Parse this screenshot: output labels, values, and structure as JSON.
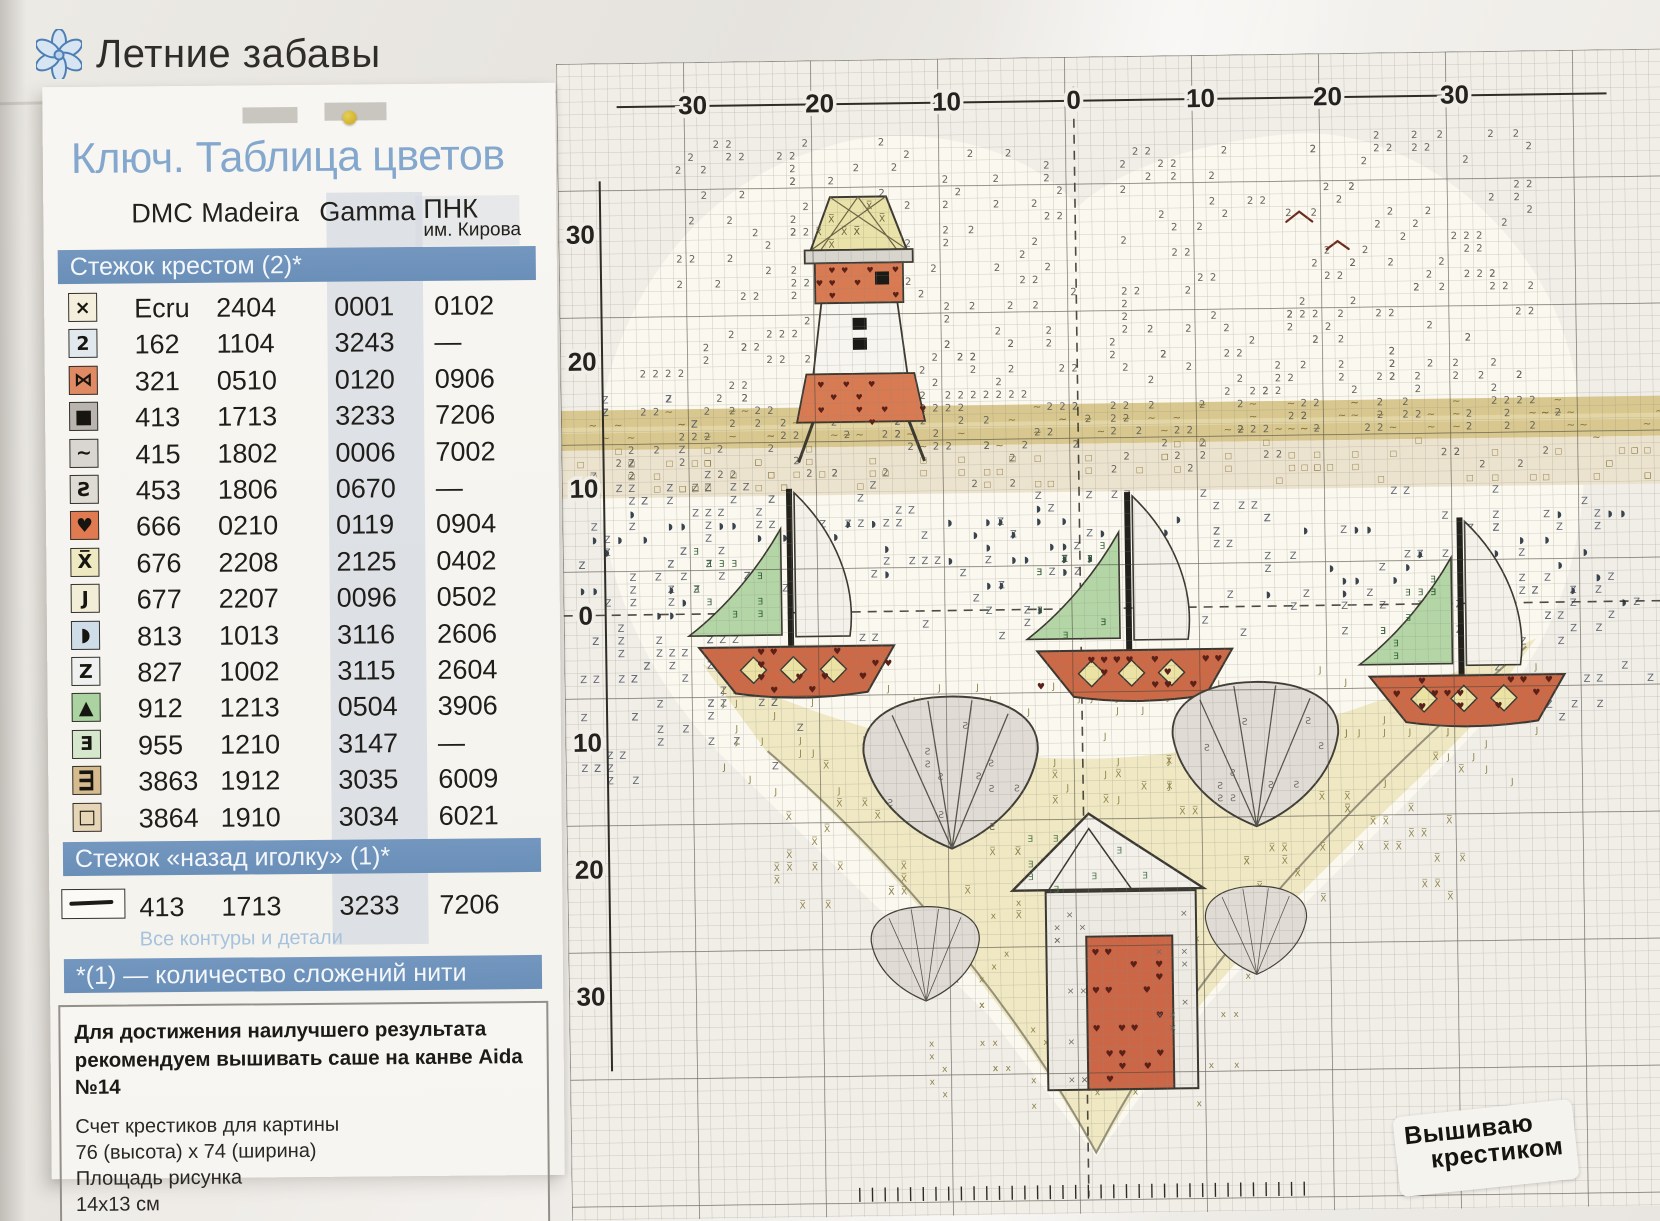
{
  "page": {
    "title": "Летние забавы",
    "stamp_line1": "Вышиваю",
    "stamp_line2": "крестиком"
  },
  "key_card": {
    "title": "Ключ. Таблица цветов",
    "columns": [
      "DMC",
      "Madeira",
      "Gamma",
      "ПНК"
    ],
    "column_sub": "им. Кирова",
    "sections": {
      "cross_stitch": "Стежок крестом (2)*",
      "backstitch": "Стежок «назад иголку» (1)*",
      "footnote": "*(1) — количество сложений нити"
    },
    "rows": [
      {
        "symbol": "×",
        "box": "#f3efdc",
        "dmc": "Ecru",
        "madeira": "2404",
        "gamma": "0001",
        "pnk": "0102"
      },
      {
        "symbol": "2",
        "box": "#e1e8ee",
        "dmc": "162",
        "madeira": "1104",
        "gamma": "3243",
        "pnk": "—"
      },
      {
        "symbol": "⋈",
        "box": "#e08a63",
        "dmc": "321",
        "madeira": "0510",
        "gamma": "0120",
        "pnk": "0906"
      },
      {
        "symbol": "■",
        "box": "#b9b5ae",
        "dmc": "413",
        "madeira": "1713",
        "gamma": "3233",
        "pnk": "7206"
      },
      {
        "symbol": "~",
        "box": "#d9d6d1",
        "dmc": "415",
        "madeira": "1802",
        "gamma": "0006",
        "pnk": "7002"
      },
      {
        "symbol": "Ƨ",
        "box": "#dedad4",
        "dmc": "453",
        "madeira": "1806",
        "gamma": "0670",
        "pnk": "—"
      },
      {
        "symbol": "♥",
        "box": "#e07a50",
        "dmc": "666",
        "madeira": "0210",
        "gamma": "0119",
        "pnk": "0904"
      },
      {
        "symbol": "X̅",
        "box": "#eee9c0",
        "dmc": "676",
        "madeira": "2208",
        "gamma": "2125",
        "pnk": "0402"
      },
      {
        "symbol": "J",
        "box": "#f1edd6",
        "dmc": "677",
        "madeira": "2207",
        "gamma": "0096",
        "pnk": "0502"
      },
      {
        "symbol": "◗",
        "box": "#cfdde9",
        "dmc": "813",
        "madeira": "1013",
        "gamma": "3116",
        "pnk": "2606"
      },
      {
        "symbol": "Z",
        "box": "#eff1f1",
        "dmc": "827",
        "madeira": "1002",
        "gamma": "3115",
        "pnk": "2604"
      },
      {
        "symbol": "▲",
        "box": "#abd3a2",
        "dmc": "912",
        "madeira": "1213",
        "gamma": "0504",
        "pnk": "3906"
      },
      {
        "symbol": "Ǝ",
        "box": "#d5e7cd",
        "dmc": "955",
        "madeira": "1210",
        "gamma": "3147",
        "pnk": "—"
      },
      {
        "symbol": "Ш",
        "rot": true,
        "box": "#d6bb8e",
        "dmc": "3863",
        "madeira": "1912",
        "gamma": "3035",
        "pnk": "6009"
      },
      {
        "symbol": "□",
        "box": "#e6d6b7",
        "dmc": "3864",
        "madeira": "1910",
        "gamma": "3034",
        "pnk": "6021"
      }
    ],
    "backstitch_row": {
      "dmc": "413",
      "madeira": "1713",
      "gamma": "3233",
      "pnk": "7206",
      "note": "Все контуры и детали"
    },
    "info_box": {
      "bold_line1": "Для достижения наилучшего результата",
      "bold_line2": "рекомендуем вышивать саше на канве Aida №14",
      "line1": "Счет крестиков для картины",
      "line2": "76 (высота) x 74 (ширина)",
      "line3": "Площадь рисунка",
      "line4": "14x13 см"
    }
  },
  "chart": {
    "top_axis": [
      "30",
      "20",
      "10",
      "0",
      "10",
      "20",
      "30"
    ],
    "left_axis": [
      "30",
      "20",
      "10",
      "0",
      "10",
      "20",
      "30"
    ],
    "motifs": [
      "lighthouse",
      "sailboat-left",
      "sailboat-center",
      "sailboat-right",
      "shell-left",
      "shell-right",
      "shell-small-left",
      "shell-small-right",
      "beach-hut",
      "seagulls",
      "heart-shape"
    ],
    "colors": {
      "grid": "#8b887d",
      "grid_bold": "#35332b",
      "red": "#cc6946",
      "sand": "#efe8c3",
      "gold_band": "#d8c78e",
      "green_sail": "#b4d6a6",
      "sky_symbol": "#65655f"
    },
    "textures": [
      {
        "layer": "under",
        "char": "2",
        "rect": [
          115,
          80,
          400,
          305
        ],
        "n": 170,
        "color": "#65655f",
        "size": 10
      },
      {
        "layer": "under",
        "char": "2",
        "rect": [
          545,
          80,
          430,
          305
        ],
        "n": 150,
        "color": "#65655f",
        "size": 10
      },
      {
        "layer": "under",
        "char": "2",
        "rect": [
          60,
          295,
          945,
          125
        ],
        "n": 115,
        "color": "#65655f",
        "size": 10
      },
      {
        "layer": "under",
        "char": "Z",
        "rect": [
          8,
          330,
          160,
          340
        ],
        "n": 55,
        "color": "#5f6671",
        "size": 10
      },
      {
        "layer": "under",
        "char": "Z",
        "rect": [
          0,
          428,
          1065,
          150
        ],
        "n": 150,
        "color": "#5f6671",
        "size": 10
      },
      {
        "layer": "under",
        "char": "◗",
        "rect": [
          0,
          452,
          1065,
          100
        ],
        "n": 80,
        "color": "#3a444e",
        "size": 9
      },
      {
        "layer": "under",
        "char": "Z",
        "rect": [
          20,
          560,
          210,
          160
        ],
        "n": 35,
        "color": "#5f6671",
        "size": 10
      },
      {
        "layer": "under",
        "char": "Z",
        "rect": [
          890,
          555,
          195,
          110
        ],
        "n": 28,
        "color": "#5f6671",
        "size": 10
      },
      {
        "layer": "under",
        "char": "~",
        "rect": [
          0,
          349,
          1100,
          36
        ],
        "n": 70,
        "color": "#7d7039",
        "size": 10
      },
      {
        "layer": "under",
        "char": "□",
        "rect": [
          0,
          388,
          1100,
          44
        ],
        "n": 85,
        "color": "#8d7c45",
        "size": 8
      },
      {
        "layer": "under",
        "char": "J",
        "rect": [
          155,
          618,
          825,
          120
        ],
        "n": 90,
        "color": "#8e844f",
        "size": 9
      },
      {
        "layer": "under",
        "char": "X̅",
        "rect": [
          200,
          700,
          700,
          155
        ],
        "n": 85,
        "color": "#8e844f",
        "size": 9
      },
      {
        "layer": "under",
        "char": "x",
        "rect": [
          340,
          845,
          385,
          200
        ],
        "n": 55,
        "color": "#8e844f",
        "size": 9
      },
      {
        "layer": "over",
        "char": "X̅",
        "rect": [
          260,
          142,
          80,
          42
        ],
        "n": 8,
        "color": "#6d6442",
        "size": 9
      },
      {
        "layer": "over",
        "char": "♥",
        "rect": [
          258,
          206,
          82,
          32
        ],
        "n": 10,
        "color": "#5a211a",
        "size": 8
      },
      {
        "layer": "over",
        "char": "♥",
        "rect": [
          242,
          318,
          114,
          38
        ],
        "n": 12,
        "color": "#5a211a",
        "size": 8
      },
      {
        "layer": "over",
        "char": "♥",
        "rect": [
          140,
          588,
          182,
          38
        ],
        "n": 14,
        "color": "#5a211a",
        "size": 9
      },
      {
        "layer": "over",
        "char": "♥",
        "rect": [
          478,
          596,
          182,
          38
        ],
        "n": 14,
        "color": "#5a211a",
        "size": 9
      },
      {
        "layer": "over",
        "char": "♥",
        "rect": [
          812,
          626,
          172,
          36
        ],
        "n": 13,
        "color": "#5a211a",
        "size": 9
      },
      {
        "layer": "over",
        "char": "Ǝ",
        "rect": [
          132,
          484,
          78,
          84
        ],
        "n": 10,
        "color": "#34613a",
        "size": 9
      },
      {
        "layer": "over",
        "char": "Ǝ",
        "rect": [
          470,
          492,
          78,
          84
        ],
        "n": 10,
        "color": "#34613a",
        "size": 9
      },
      {
        "layer": "over",
        "char": "Ǝ",
        "rect": [
          802,
          522,
          78,
          84
        ],
        "n": 10,
        "color": "#34613a",
        "size": 9
      },
      {
        "layer": "over",
        "char": "♥",
        "rect": [
          524,
          888,
          72,
          134
        ],
        "n": 18,
        "color": "#5a211a",
        "size": 9
      },
      {
        "layer": "over",
        "char": "Ǝ",
        "rect": [
          458,
          786,
          122,
          42
        ],
        "n": 8,
        "color": "#4e7a50",
        "size": 9
      },
      {
        "layer": "over",
        "char": "×",
        "rect": [
          482,
          842,
          38,
          180
        ],
        "n": 12,
        "color": "#6e6b62",
        "size": 9
      },
      {
        "layer": "over",
        "char": "×",
        "rect": [
          588,
          842,
          34,
          180
        ],
        "n": 10,
        "color": "#6e6b62",
        "size": 9
      },
      {
        "layer": "over",
        "char": "Ƨ",
        "rect": [
          312,
          670,
          150,
          100
        ],
        "n": 12,
        "color": "#6f6a60",
        "size": 9
      },
      {
        "layer": "over",
        "char": "Ƨ",
        "rect": [
          615,
          648,
          148,
          95
        ],
        "n": 10,
        "color": "#6f6a60",
        "size": 9
      }
    ]
  }
}
